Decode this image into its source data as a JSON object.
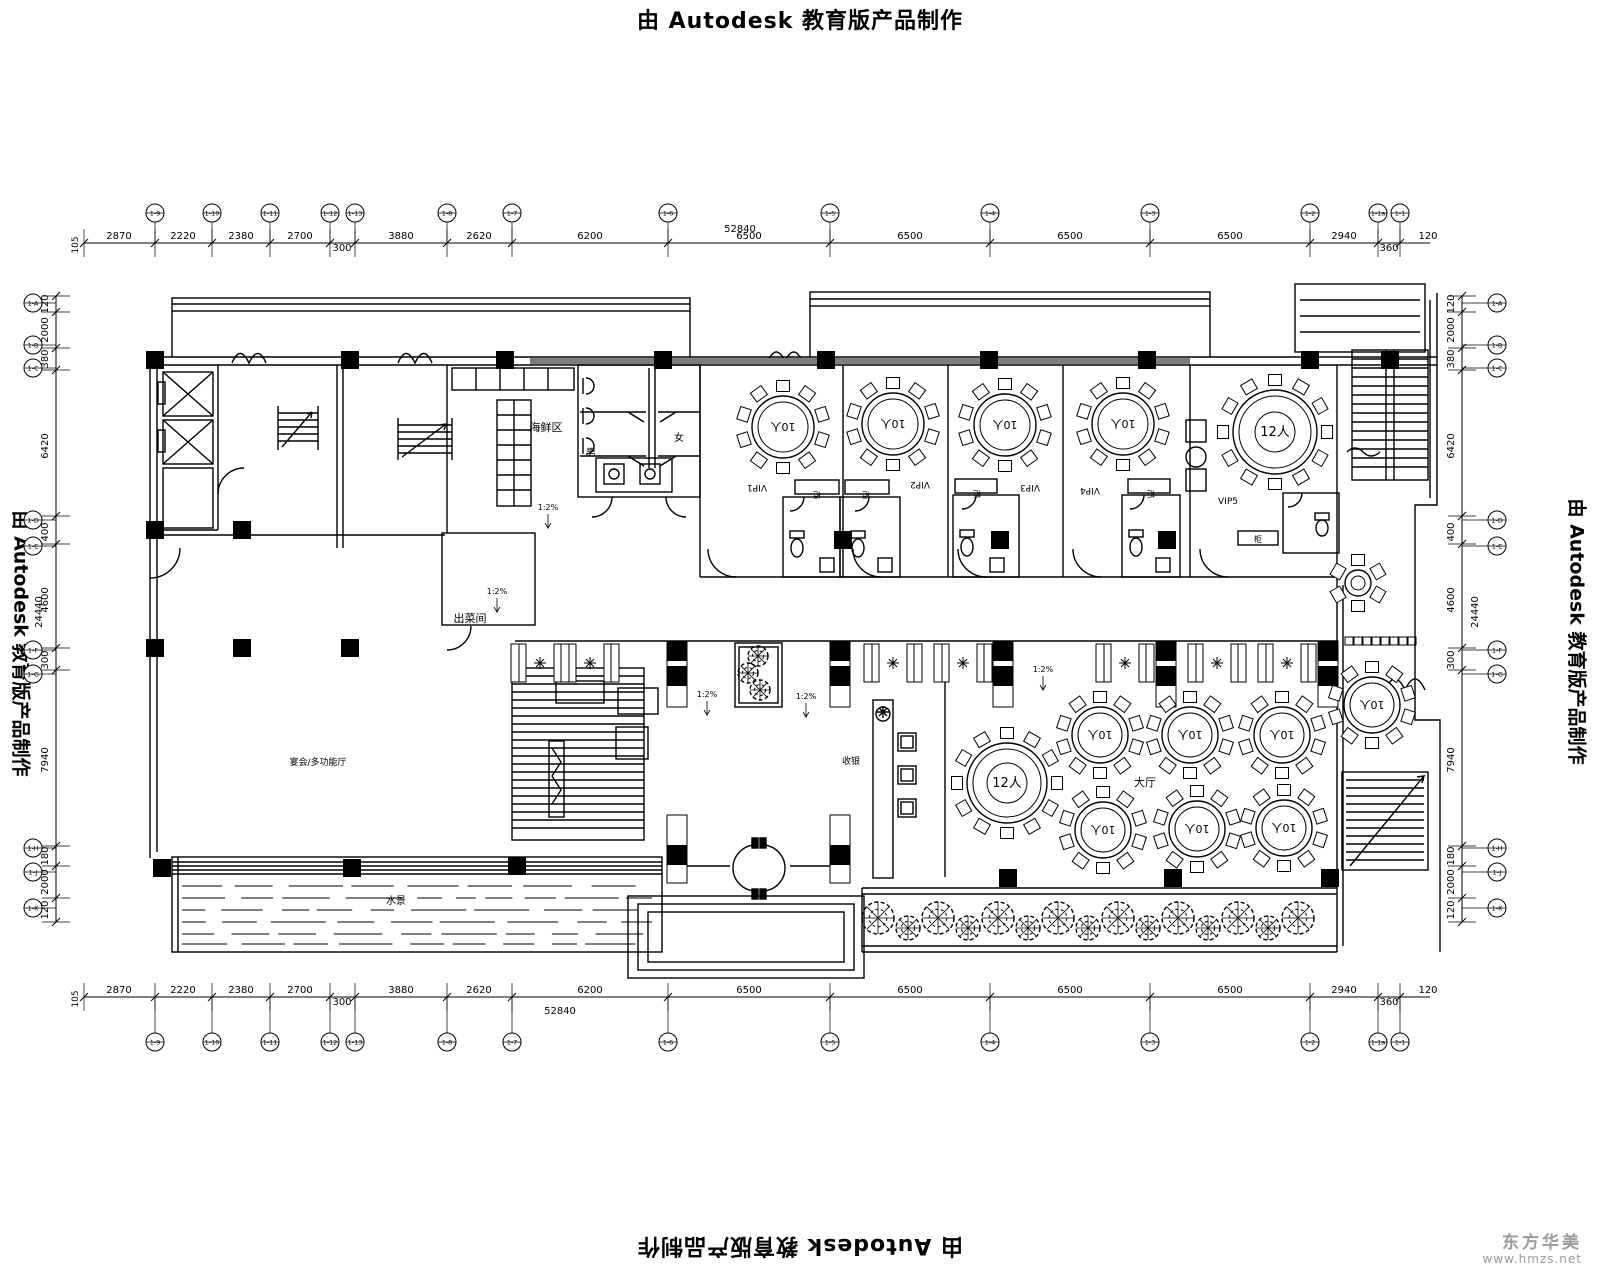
{
  "watermark": {
    "text": "由 Autodesk 教育版产品制作"
  },
  "logo": {
    "name": "东方华美",
    "url": "www.hmzs.net",
    "color": "#9b9b9b"
  },
  "colors": {
    "line": "#000000",
    "beam": "#7d7d7d"
  },
  "room_labels": [
    {
      "t": "海鲜区",
      "x": 546,
      "y": 431,
      "s": 11
    },
    {
      "t": "男",
      "x": 591,
      "y": 456,
      "s": 10
    },
    {
      "t": "女",
      "x": 679,
      "y": 441,
      "s": 10
    },
    {
      "t": "出菜间",
      "x": 470,
      "y": 622,
      "s": 11
    },
    {
      "t": "VIP1",
      "x": 757,
      "y": 485,
      "s": 9,
      "r": 180
    },
    {
      "t": "VIP2",
      "x": 920,
      "y": 482,
      "s": 9,
      "r": 180
    },
    {
      "t": "VIP3",
      "x": 1030,
      "y": 485,
      "s": 9,
      "r": 180
    },
    {
      "t": "VIP4",
      "x": 1090,
      "y": 488,
      "s": 9,
      "r": 180
    },
    {
      "t": "VIP5",
      "x": 1228,
      "y": 504,
      "s": 9
    },
    {
      "t": "柜",
      "x": 817,
      "y": 492,
      "s": 8,
      "r": 180
    },
    {
      "t": "柜",
      "x": 866,
      "y": 492,
      "s": 8,
      "r": 180
    },
    {
      "t": "柜",
      "x": 977,
      "y": 491,
      "s": 8,
      "r": 180
    },
    {
      "t": "柜",
      "x": 1151,
      "y": 491,
      "s": 8,
      "r": 180
    },
    {
      "t": "柜",
      "x": 1258,
      "y": 542,
      "s": 8
    },
    {
      "t": "收银",
      "x": 851,
      "y": 764,
      "s": 9
    },
    {
      "t": "大厅",
      "x": 1145,
      "y": 786,
      "s": 11
    },
    {
      "t": "宴会/多功能厅",
      "x": 318,
      "y": 765,
      "s": 9
    },
    {
      "t": "水景",
      "x": 396,
      "y": 904,
      "s": 10
    }
  ],
  "ramp_labels": [
    {
      "t": "1:2%",
      "x": 548,
      "y": 510
    },
    {
      "t": "1:2%",
      "x": 497,
      "y": 594
    },
    {
      "t": "1:2%",
      "x": 707,
      "y": 697
    },
    {
      "t": "1:2%",
      "x": 806,
      "y": 699
    },
    {
      "t": "1:2%",
      "x": 1043,
      "y": 672
    }
  ],
  "tables": [
    {
      "cx": 783,
      "cy": 427,
      "r": 31,
      "label": "10人",
      "seats": 10,
      "rot": 180
    },
    {
      "cx": 893,
      "cy": 424,
      "r": 31,
      "label": "10人",
      "seats": 10,
      "rot": 180
    },
    {
      "cx": 1005,
      "cy": 425,
      "r": 31,
      "label": "10人",
      "seats": 10,
      "rot": 180
    },
    {
      "cx": 1123,
      "cy": 424,
      "r": 31,
      "label": "10人",
      "seats": 10,
      "rot": 180
    },
    {
      "cx": 1275,
      "cy": 432,
      "r": 42,
      "label": "12人",
      "seats": 12,
      "rot": 0,
      "ring": true
    },
    {
      "cx": 1007,
      "cy": 783,
      "r": 40,
      "label": "12人",
      "seats": 12,
      "rot": 0,
      "ring": true
    },
    {
      "cx": 1100,
      "cy": 735,
      "r": 28,
      "label": "10人",
      "seats": 10,
      "rot": 180
    },
    {
      "cx": 1190,
      "cy": 735,
      "r": 28,
      "label": "10人",
      "seats": 10,
      "rot": 180
    },
    {
      "cx": 1282,
      "cy": 735,
      "r": 28,
      "label": "10人",
      "seats": 10,
      "rot": 180
    },
    {
      "cx": 1372,
      "cy": 705,
      "r": 28,
      "label": "10人",
      "seats": 10,
      "rot": 180
    },
    {
      "cx": 1103,
      "cy": 830,
      "r": 28,
      "label": "10人",
      "seats": 10,
      "rot": 180
    },
    {
      "cx": 1197,
      "cy": 829,
      "r": 28,
      "label": "10人",
      "seats": 10,
      "rot": 180
    },
    {
      "cx": 1284,
      "cy": 828,
      "r": 28,
      "label": "10人",
      "seats": 10,
      "rot": 180
    },
    {
      "cx": 1358,
      "cy": 583,
      "r": 13,
      "label": "",
      "seats": 6,
      "rot": 0
    }
  ],
  "dims": {
    "top": {
      "line_y": 243,
      "ticks": [
        84,
        155,
        212,
        270,
        330,
        355,
        447,
        512,
        668,
        830,
        990,
        1150,
        1310,
        1378,
        1400
      ],
      "values": [
        {
          "v": "105",
          "x": 78,
          "rot": true
        },
        {
          "v": "2870",
          "x": 119
        },
        {
          "v": "2220",
          "x": 183
        },
        {
          "v": "2380",
          "x": 241
        },
        {
          "v": "2700",
          "x": 300
        },
        {
          "v": "300",
          "x": 342,
          "dy": 12
        },
        {
          "v": "3880",
          "x": 401
        },
        {
          "v": "2620",
          "x": 479
        },
        {
          "v": "6200",
          "x": 590
        },
        {
          "v": "6500",
          "x": 749
        },
        {
          "v": "6500",
          "x": 910
        },
        {
          "v": "6500",
          "x": 1070
        },
        {
          "v": "6500",
          "x": 1230
        },
        {
          "v": "2940",
          "x": 1344
        },
        {
          "v": "360",
          "x": 1389,
          "dy": 12
        },
        {
          "v": "120",
          "x": 1428
        }
      ],
      "total": {
        "v": "52840",
        "x": 740,
        "y": 232
      }
    },
    "bottom": {
      "line_y": 997,
      "ticks": [
        84,
        155,
        212,
        270,
        330,
        355,
        447,
        512,
        668,
        830,
        990,
        1150,
        1310,
        1378,
        1400
      ],
      "values": [
        {
          "v": "105",
          "x": 78,
          "rot": true
        },
        {
          "v": "2870",
          "x": 119
        },
        {
          "v": "2220",
          "x": 183
        },
        {
          "v": "2380",
          "x": 241
        },
        {
          "v": "2700",
          "x": 300
        },
        {
          "v": "300",
          "x": 342,
          "dy": 12
        },
        {
          "v": "3880",
          "x": 401
        },
        {
          "v": "2620",
          "x": 479
        },
        {
          "v": "6200",
          "x": 590
        },
        {
          "v": "6500",
          "x": 749
        },
        {
          "v": "6500",
          "x": 910
        },
        {
          "v": "6500",
          "x": 1070
        },
        {
          "v": "6500",
          "x": 1230
        },
        {
          "v": "2940",
          "x": 1344
        },
        {
          "v": "360",
          "x": 1389,
          "dy": 12
        },
        {
          "v": "120",
          "x": 1428
        }
      ],
      "total": {
        "v": "52840",
        "x": 560,
        "y": 1014
      }
    },
    "left": {
      "line_x": 56,
      "ticks": [
        296,
        312,
        348,
        370,
        516,
        544,
        648,
        670,
        846,
        866,
        898,
        922
      ],
      "values": [
        {
          "v": "120",
          "y": 304
        },
        {
          "v": "2000",
          "y": 330
        },
        {
          "v": "380",
          "y": 359
        },
        {
          "v": "6420",
          "y": 446
        },
        {
          "v": "400",
          "y": 532
        },
        {
          "v": "4600",
          "y": 600
        },
        {
          "v": "300",
          "y": 660
        },
        {
          "v": "7940",
          "y": 760
        },
        {
          "v": "180",
          "y": 856
        },
        {
          "v": "2000",
          "y": 882
        },
        {
          "v": "120",
          "y": 910
        }
      ],
      "total": {
        "v": "24440",
        "x": 42,
        "y": 612
      }
    },
    "right": {
      "line_x": 1462,
      "ticks": [
        296,
        312,
        348,
        370,
        516,
        544,
        648,
        670,
        846,
        866,
        898,
        922
      ],
      "values": [
        {
          "v": "120",
          "y": 304
        },
        {
          "v": "2000",
          "y": 330
        },
        {
          "v": "380",
          "y": 359
        },
        {
          "v": "6420",
          "y": 446
        },
        {
          "v": "400",
          "y": 532
        },
        {
          "v": "4600",
          "y": 600
        },
        {
          "v": "300",
          "y": 660
        },
        {
          "v": "7940",
          "y": 760
        },
        {
          "v": "180",
          "y": 856
        },
        {
          "v": "2000",
          "y": 882
        },
        {
          "v": "120",
          "y": 910
        }
      ],
      "total": {
        "v": "24440",
        "x": 1478,
        "y": 612
      }
    }
  },
  "grid_bubbles": {
    "top": {
      "cy": 213,
      "items": [
        {
          "l": "1-9",
          "x": 155
        },
        {
          "l": "1-10",
          "x": 212
        },
        {
          "l": "1-11",
          "x": 270
        },
        {
          "l": "1-12",
          "x": 330
        },
        {
          "l": "1-13",
          "x": 355
        },
        {
          "l": "1-8",
          "x": 447
        },
        {
          "l": "1-7",
          "x": 512
        },
        {
          "l": "1-6",
          "x": 668
        },
        {
          "l": "1-5",
          "x": 830
        },
        {
          "l": "1-4",
          "x": 990
        },
        {
          "l": "1-3",
          "x": 1150
        },
        {
          "l": "1-2",
          "x": 1310
        },
        {
          "l": "1-1a",
          "x": 1378
        },
        {
          "l": "1-1",
          "x": 1400
        }
      ]
    },
    "bottom": {
      "cy": 1042,
      "items": [
        {
          "l": "1-9",
          "x": 155
        },
        {
          "l": "1-10",
          "x": 212
        },
        {
          "l": "1-11",
          "x": 270
        },
        {
          "l": "1-12",
          "x": 330
        },
        {
          "l": "1-13",
          "x": 355
        },
        {
          "l": "1-8",
          "x": 447
        },
        {
          "l": "1-7",
          "x": 512
        },
        {
          "l": "1-6",
          "x": 668
        },
        {
          "l": "1-5",
          "x": 830
        },
        {
          "l": "1-4",
          "x": 990
        },
        {
          "l": "1-3",
          "x": 1150
        },
        {
          "l": "1-2",
          "x": 1310
        },
        {
          "l": "1-1a",
          "x": 1378
        },
        {
          "l": "1-1",
          "x": 1400
        }
      ]
    },
    "left": {
      "cx": 33,
      "items": [
        {
          "l": "1-A",
          "y": 303
        },
        {
          "l": "1-B",
          "y": 345
        },
        {
          "l": "1-C",
          "y": 368
        },
        {
          "l": "1-D",
          "y": 520
        },
        {
          "l": "1-E",
          "y": 546
        },
        {
          "l": "1-F",
          "y": 650
        },
        {
          "l": "1-G",
          "y": 674
        },
        {
          "l": "1-H",
          "y": 848
        },
        {
          "l": "1-J",
          "y": 872
        },
        {
          "l": "1-K",
          "y": 908
        }
      ]
    },
    "right": {
      "cx": 1497,
      "items": [
        {
          "l": "1-A",
          "y": 303
        },
        {
          "l": "1-B",
          "y": 345
        },
        {
          "l": "1-C",
          "y": 368
        },
        {
          "l": "1-D",
          "y": 520
        },
        {
          "l": "1-E",
          "y": 546
        },
        {
          "l": "1-F",
          "y": 650
        },
        {
          "l": "1-G",
          "y": 674
        },
        {
          "l": "1-H",
          "y": 848
        },
        {
          "l": "1-J",
          "y": 872
        },
        {
          "l": "1-K",
          "y": 908
        }
      ]
    }
  },
  "columns": [
    [
      155,
      360
    ],
    [
      350,
      360
    ],
    [
      505,
      360
    ],
    [
      663,
      360
    ],
    [
      826,
      360
    ],
    [
      989,
      360
    ],
    [
      1147,
      360
    ],
    [
      1310,
      360
    ],
    [
      1390,
      360
    ],
    [
      155,
      530
    ],
    [
      242,
      530
    ],
    [
      843,
      540
    ],
    [
      1000,
      540
    ],
    [
      1167,
      540
    ],
    [
      155,
      648
    ],
    [
      242,
      648
    ],
    [
      350,
      648
    ],
    [
      162,
      868
    ],
    [
      352,
      868
    ],
    [
      517,
      866
    ],
    [
      1008,
      878
    ],
    [
      1173,
      878
    ],
    [
      1330,
      878
    ]
  ],
  "pilasters_top": [
    677,
    840,
    1003,
    1166,
    1328
  ],
  "pilasters_bottom": [
    677,
    840
  ],
  "booths": [
    540,
    590,
    893,
    963,
    1125,
    1217,
    1287
  ],
  "trees_row": {
    "y": 922,
    "xs": [
      878,
      908,
      938,
      968,
      998,
      1028,
      1058,
      1088,
      1118,
      1148,
      1178,
      1208,
      1238,
      1268,
      1298
    ]
  },
  "planter_trees": [
    [
      758,
      656
    ],
    [
      748,
      673
    ],
    [
      760,
      690
    ]
  ],
  "cabinet_squares": {
    "y": 637,
    "x0": 1345,
    "n": 8,
    "step": 9
  }
}
